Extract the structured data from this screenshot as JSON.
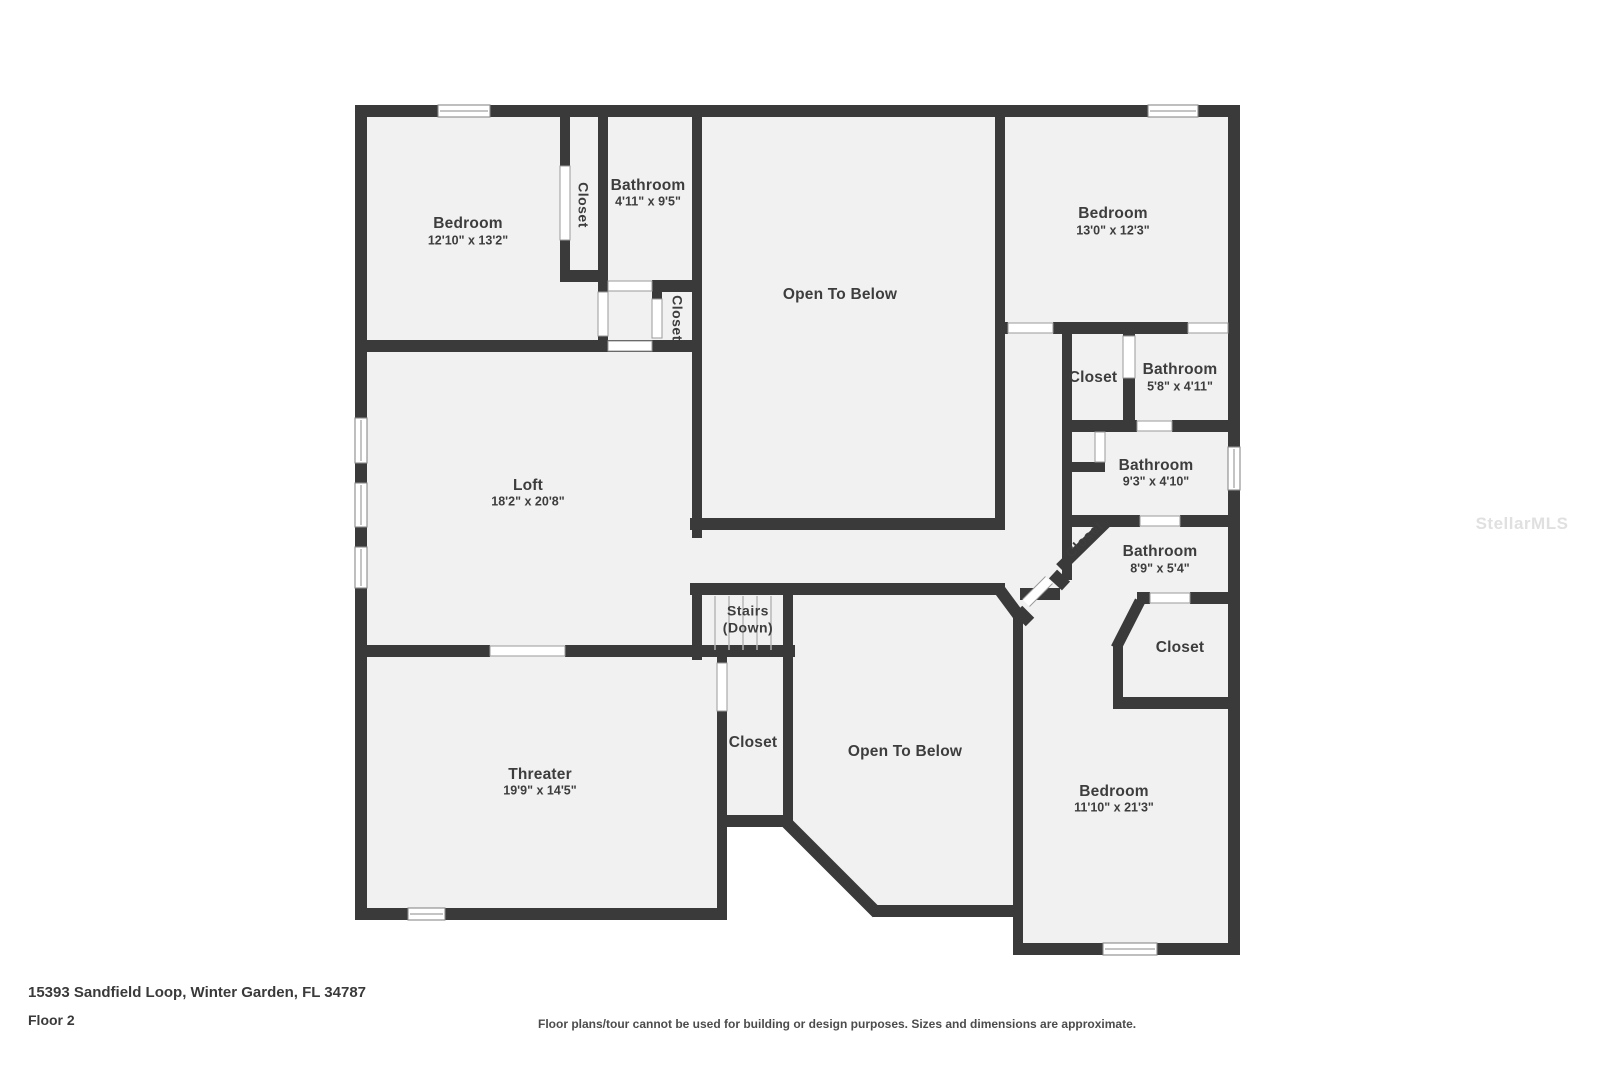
{
  "plan": {
    "rooms": [
      {
        "id": "bedroom-1",
        "name": "Bedroom",
        "dims": "12'10\" x 13'2\""
      },
      {
        "id": "bathroom-1",
        "name": "Bathroom",
        "dims": "4'11\" x 9'5\""
      },
      {
        "id": "closet-1",
        "name": "Closet"
      },
      {
        "id": "closet-2",
        "name": "Closet"
      },
      {
        "id": "open-below-1",
        "name": "Open To Below"
      },
      {
        "id": "bedroom-2",
        "name": "Bedroom",
        "dims": "13'0\" x 12'3\""
      },
      {
        "id": "closet-3",
        "name": "Closet"
      },
      {
        "id": "bathroom-2",
        "name": "Bathroom",
        "dims": "5'8\" x 4'11\""
      },
      {
        "id": "bathroom-3",
        "name": "Bathroom",
        "dims": "9'3\" x 4'10\""
      },
      {
        "id": "closet-4",
        "name": "Closet"
      },
      {
        "id": "bathroom-4",
        "name": "Bathroom",
        "dims": "8'9\" x 5'4\""
      },
      {
        "id": "closet-5",
        "name": "Closet"
      },
      {
        "id": "loft",
        "name": "Loft",
        "dims": "18'2\" x 20'8\""
      },
      {
        "id": "stairs",
        "name": "Stairs",
        "dims": "(Down)"
      },
      {
        "id": "closet-6",
        "name": "Closet"
      },
      {
        "id": "theater",
        "name": "Threater",
        "dims": "19'9\" x 14'5\""
      },
      {
        "id": "open-below-2",
        "name": "Open To Below"
      },
      {
        "id": "bedroom-3",
        "name": "Bedroom",
        "dims": "11'10\" x 21'3\""
      }
    ],
    "colors": {
      "wall": "#3a3a3a",
      "floor": "#f1f1f1",
      "text": "#3d3d3d"
    }
  },
  "footer": {
    "address": "15393 Sandfield Loop, Winter Garden, FL 34787",
    "floor": "Floor 2",
    "disclaimer": "Floor plans/tour cannot be used for building or design purposes. Sizes and dimensions are approximate."
  },
  "watermark": "StellarMLS"
}
